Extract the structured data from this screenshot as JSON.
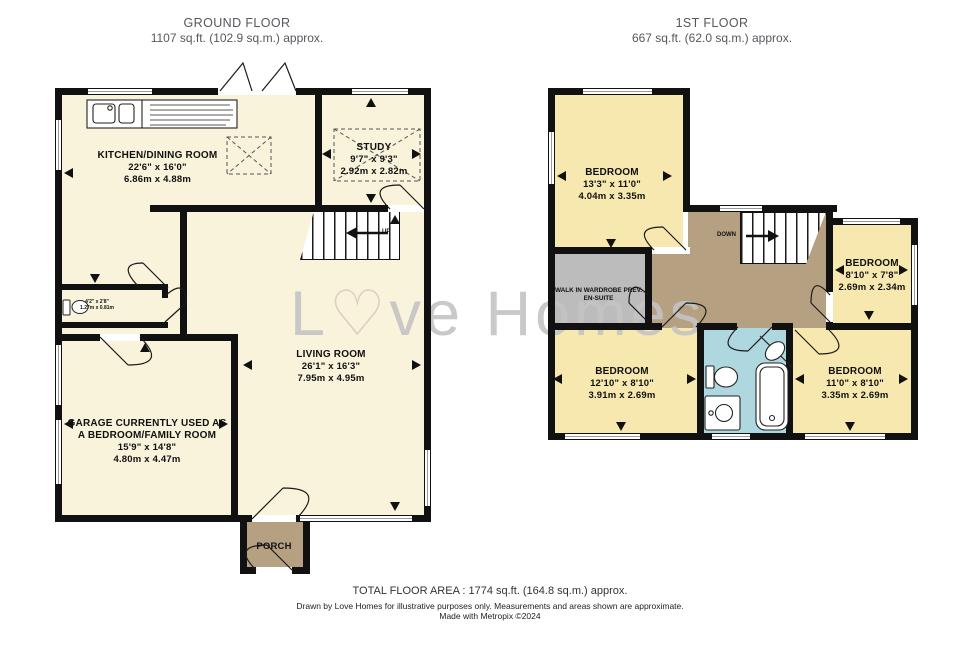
{
  "ground_floor": {
    "title": "GROUND FLOOR",
    "area": "1107 sq.ft. (102.9 sq.m.) approx.",
    "rooms": {
      "kitchen": {
        "name": "KITCHEN/DINING ROOM",
        "imperial": "22'6\"  x 16'0\"",
        "metric": "6.86m  x 4.88m"
      },
      "study": {
        "name": "STUDY",
        "imperial": "9'7\"  x 9'3\"",
        "metric": "2.92m  x 2.82m"
      },
      "living": {
        "name": "LIVING ROOM",
        "imperial": "26'1\"  x 16'3\"",
        "metric": "7.95m  x 4.95m"
      },
      "garage": {
        "name_line1": "GARAGE CURRENTLY USED AS",
        "name_line2": "A BEDROOM/FAMILY ROOM",
        "imperial": "15'9\"  x 14'8\"",
        "metric": "4.80m  x 4.47m"
      },
      "porch": {
        "name": "PORCH"
      },
      "wc": {
        "imperial": "4'2\" x 2'8\"",
        "metric": "1.27m x 0.81m"
      }
    },
    "stairs_label": "UP"
  },
  "first_floor": {
    "title": "1ST FLOOR",
    "area": "667 sq.ft. (62.0 sq.m.) approx.",
    "rooms": {
      "bedroom1": {
        "name": "BEDROOM",
        "imperial": "13'3\"  x 11'0\"",
        "metric": "4.04m  x 3.35m"
      },
      "bedroom2": {
        "name": "BEDROOM",
        "imperial": "8'10\"  x 7'8\"",
        "metric": "2.69m  x 2.34m"
      },
      "bedroom3": {
        "name": "BEDROOM",
        "imperial": "12'10\"  x 8'10\"",
        "metric": "3.91m  x 2.69m"
      },
      "bedroom4": {
        "name": "BEDROOM",
        "imperial": "11'0\"  x 8'10\"",
        "metric": "3.35m  x 2.69m"
      },
      "wardrobe": {
        "name_line1": "WALK IN WARDROBE PREV.",
        "name_line2": "EN-SUITE"
      }
    },
    "stairs_label": "DOWN"
  },
  "watermark": {
    "prefix": "L",
    "heart": "♡",
    "suffix": "ve Homes"
  },
  "footer": {
    "total": "TOTAL FLOOR AREA : 1774 sq.ft. (164.8 sq.m.) approx.",
    "disclaimer": "Drawn by Love Homes for illustrative purposes only. Measurements and areas shown are approximate.",
    "credit": "Made with Metropix ©2024"
  },
  "colors": {
    "ground_room": "#f8f3da",
    "first_room": "#f6e8ae",
    "hall_landing": "#b5a081",
    "bathroom": "#aed7e0",
    "wardrobe": "#bcbcbc",
    "wall": "#111111",
    "watermark": "#c4c4c4"
  }
}
